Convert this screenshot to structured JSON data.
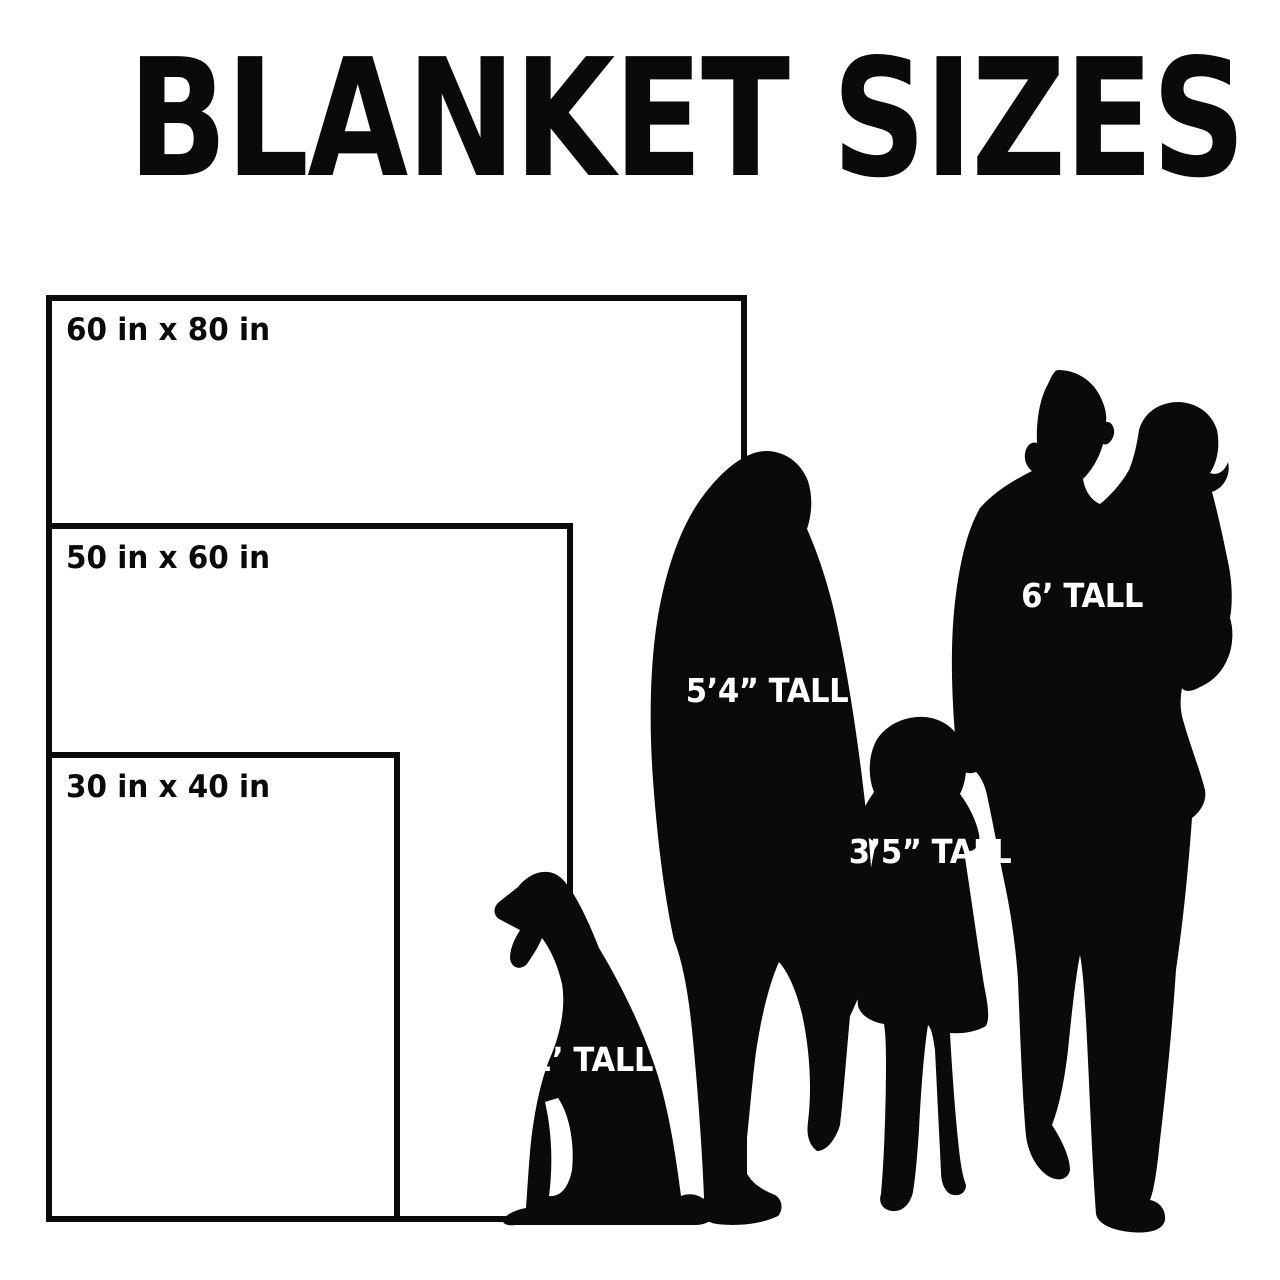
{
  "title": "BLANKET SIZES",
  "blankets": [
    {
      "name": "60x80",
      "label": "60 in x 80 in"
    },
    {
      "name": "50x60",
      "label": "50 in x 60 in"
    },
    {
      "name": "30x40",
      "label": "30 in x 40 in"
    }
  ],
  "figures": {
    "dog": {
      "label": "2’ TALL",
      "height": "2 feet"
    },
    "woman": {
      "label": "5’4” TALL",
      "height": "5 feet 4 inches"
    },
    "child": {
      "label": "3’5” TALL",
      "height": "3 feet 5 inches"
    },
    "man": {
      "label": "6’ TALL",
      "height": "6 feet"
    }
  },
  "colors": {
    "background": "#ffffff",
    "ink": "#0a0a0a",
    "figure_label_text": "#ffffff"
  }
}
